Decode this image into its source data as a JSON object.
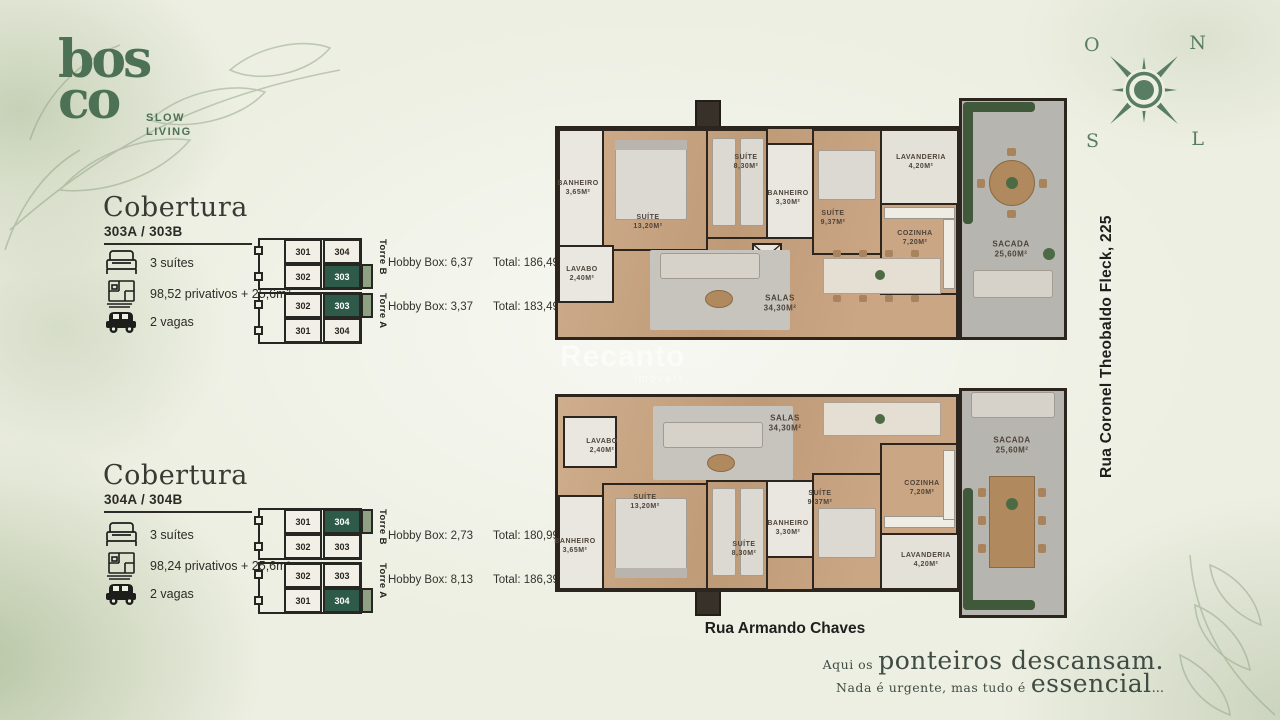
{
  "colors": {
    "brand_green": "#4d7154",
    "compass_green": "#587d63",
    "diagram_highlight_green": "#2e5a49",
    "diagram_balcony_green": "#8ea183",
    "wood_floor": "#c8a585",
    "terrace_gray": "#b7b5af",
    "wall_dark": "#2b251e",
    "background_cream": "#edefe2"
  },
  "logo": {
    "line1": "bos",
    "line2": "co",
    "tagline_line1": "SLOW",
    "tagline_line2": "LIVING"
  },
  "compass": {
    "nw": "O",
    "ne": "N",
    "sw": "S",
    "se": "L"
  },
  "right_street": "Rua Coronel Theobaldo Fleck, 225",
  "bottom_street": "Rua Armando Chaves",
  "watermark": {
    "name": "Recanto",
    "sub": "imóveis"
  },
  "quote": {
    "lead_small": "Aqui os",
    "lead_big": "ponteiros descansam.",
    "tail_small": "Nada é urgente, mas tudo é",
    "tail_big": "essencial",
    "tail_dots": "..."
  },
  "sections": [
    {
      "title": "Cobertura",
      "subtitle": "303A / 303B",
      "specs": [
        {
          "icon": "bed-icon",
          "label": "3 suítes"
        },
        {
          "icon": "floorplan-icon",
          "label": "98,52 privativos + 25,6m²"
        },
        {
          "icon": "car-icon",
          "label": "2 vagas"
        }
      ],
      "diagrams": [
        {
          "torre": "Torre B",
          "cells": [
            "301",
            "304",
            "302",
            "303"
          ],
          "highlight": "303",
          "hobby": "Hobby Box: 6,37",
          "total": "Total: 186,49m²"
        },
        {
          "torre": "Torre A",
          "cells": [
            "302",
            "303",
            "301",
            "304"
          ],
          "highlight": "303",
          "hobby": "Hobby Box: 3,37",
          "total": "Total: 183,49m²"
        }
      ]
    },
    {
      "title": "Cobertura",
      "subtitle": "304A / 304B",
      "specs": [
        {
          "icon": "bed-icon",
          "label": "3 suítes"
        },
        {
          "icon": "floorplan-icon",
          "label": "98,24 privativos + 25,6m²"
        },
        {
          "icon": "car-icon",
          "label": "2 vagas"
        }
      ],
      "diagrams": [
        {
          "torre": "Torre B",
          "cells": [
            "301",
            "304",
            "302",
            "303"
          ],
          "highlight": "304",
          "hobby": "Hobby Box: 2,73",
          "total": "Total: 180,99m²"
        },
        {
          "torre": "Torre A",
          "cells": [
            "302",
            "303",
            "301",
            "304"
          ],
          "highlight": "304",
          "hobby": "Hobby Box: 8,13",
          "total": "Total: 186,39m²"
        }
      ]
    }
  ],
  "plans": [
    {
      "id": "upper-floorplan",
      "rooms": [
        {
          "name": "BANHEIRO",
          "area": "3,65M²"
        },
        {
          "name": "SUÍTE",
          "area": "13,20M²"
        },
        {
          "name": "SUÍTE",
          "area": "8,30M²"
        },
        {
          "name": "BANHEIRO",
          "area": "3,30M²"
        },
        {
          "name": "SUÍTE",
          "area": "9,37M²"
        },
        {
          "name": "LAVANDERIA",
          "area": "4,20M²"
        },
        {
          "name": "COZINHA",
          "area": "7,20M²"
        },
        {
          "name": "LAVABO",
          "area": "2,40M²"
        },
        {
          "name": "SALAS",
          "area": "34,30M²"
        },
        {
          "name": "SACADA",
          "area": "25,60M²"
        }
      ]
    },
    {
      "id": "lower-floorplan",
      "rooms": [
        {
          "name": "BANHEIRO",
          "area": "3,65M²"
        },
        {
          "name": "SUÍTE",
          "area": "13,20M²"
        },
        {
          "name": "SUÍTE",
          "area": "8,30M²"
        },
        {
          "name": "BANHEIRO",
          "area": "3,30M²"
        },
        {
          "name": "SUÍTE",
          "area": "9,37M²"
        },
        {
          "name": "LAVANDERIA",
          "area": "4,20M²"
        },
        {
          "name": "COZINHA",
          "area": "7,20M²"
        },
        {
          "name": "LAVABO",
          "area": "2,40M²"
        },
        {
          "name": "SALAS",
          "area": "34,30M²"
        },
        {
          "name": "SACADA",
          "area": "25,60M²"
        }
      ]
    }
  ]
}
